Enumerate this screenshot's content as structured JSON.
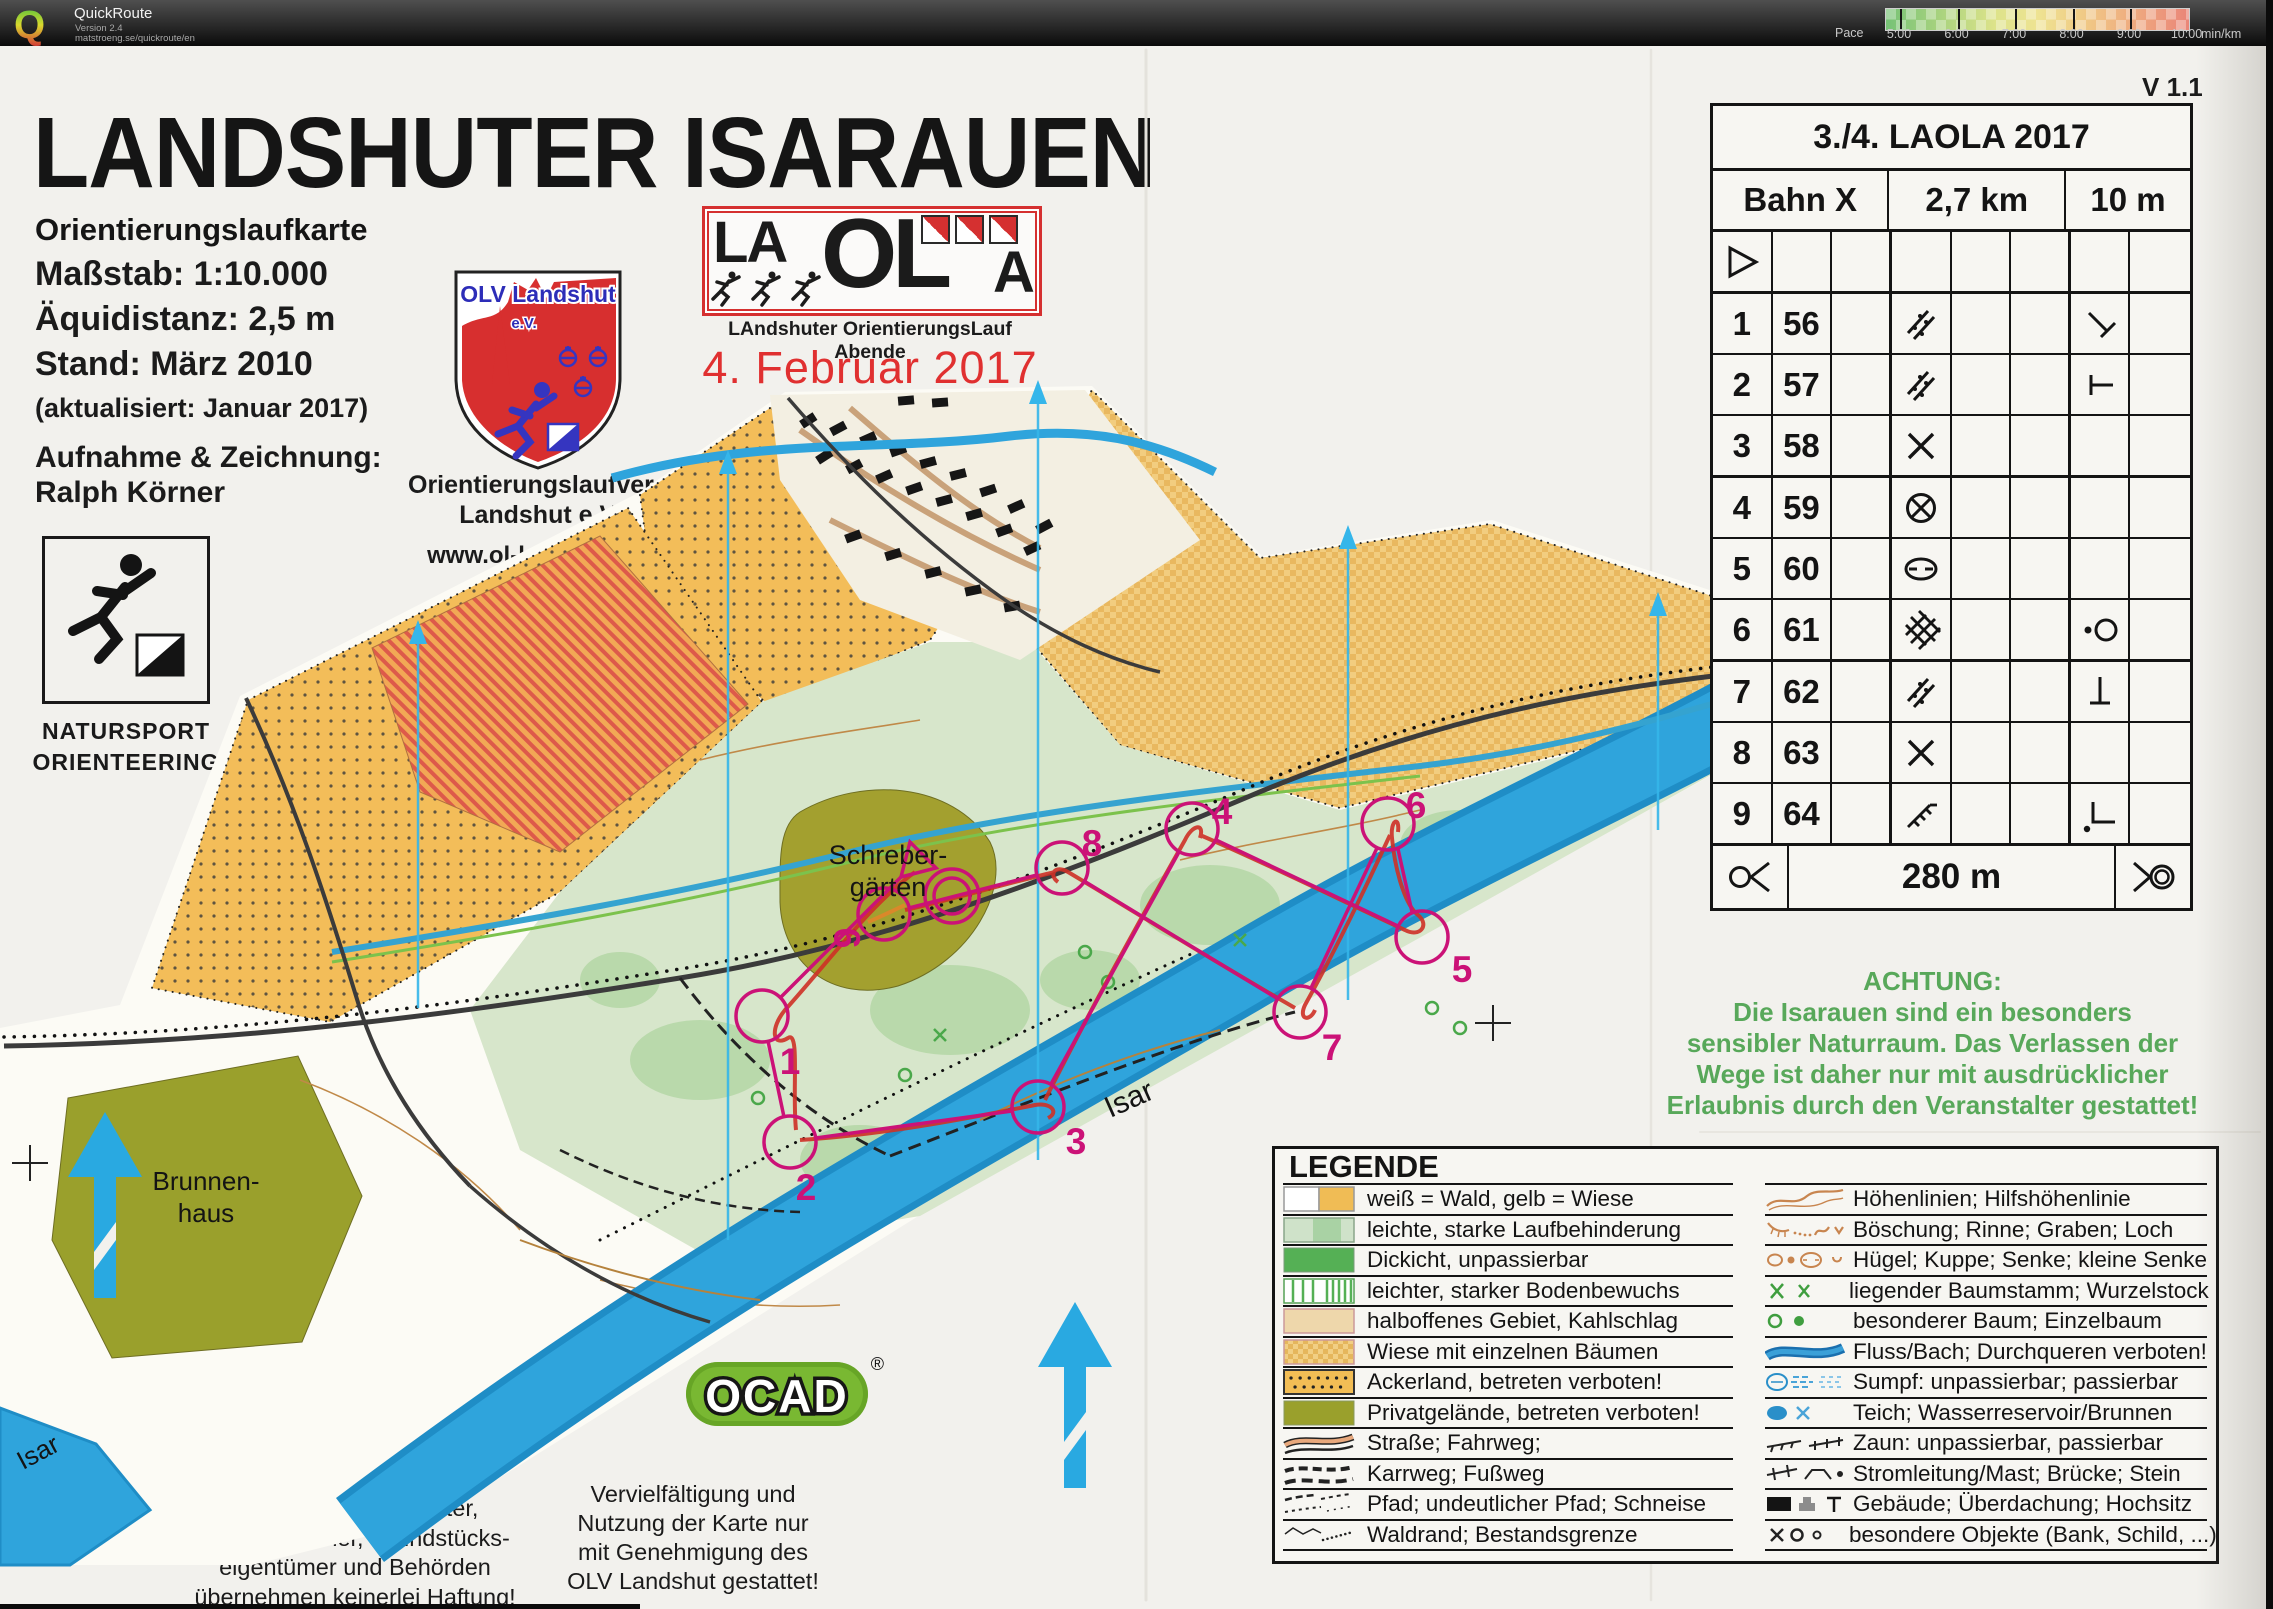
{
  "quickroute_bar": {
    "app_name": "QuickRoute",
    "version": "Version 2.4",
    "url": "matstroeng.se/quickroute/en",
    "pace_label": "Pace",
    "pace_ticks": [
      "5:00",
      "6:00",
      "7:00",
      "8:00",
      "9:00",
      "10:00"
    ],
    "pace_unit": "min/km"
  },
  "version_label": "V 1.1",
  "title_block": {
    "title": "LANDSHU​TER ISARAUEN",
    "subtitle": "Orientierungslaufkarte",
    "scale": "Maßstab: 1:10.000",
    "equidistance": "Äquidistanz: 2,5 m",
    "stand": "Stand: März 2010",
    "updated": "(aktualisiert: Januar 2017)",
    "survey_label": "Aufnahme & Zeichnung:",
    "survey_name": "Ralph Körner"
  },
  "natursport_logo": {
    "line1": "NATURSPORT",
    "line2": "ORIENTEERING"
  },
  "olv_logo": {
    "shield_title": "OLV Landshut",
    "shield_sub": "e.V.",
    "org_line1": "Orientierungslaufverein",
    "org_line2": "Landshut e.V.",
    "website": "www.ol-landshut.de"
  },
  "laola": {
    "letters": [
      "LA",
      "OL",
      "A"
    ],
    "tagline": "LAndshuter OrientierungsLauf Abende",
    "date": "4. Februar 2017"
  },
  "map_labels": {
    "allotments1": "Schreber-",
    "allotments2": "gärten",
    "well1": "Brunnen-",
    "well2": "haus",
    "river": "Isar",
    "river2": "Isar"
  },
  "course": {
    "controls": [
      "1",
      "2",
      "3",
      "4",
      "5",
      "6",
      "7",
      "8",
      "9"
    ]
  },
  "control_table": {
    "title": "3./4. LAOLA 2017",
    "course": "Bahn X",
    "length": "2,7 km",
    "climb": "10 m",
    "rows": [
      {
        "start": true,
        "num": "",
        "code": ""
      },
      {
        "num": "1",
        "code": "56",
        "d": "scattered-trees",
        "g": "junction-diagonal"
      },
      {
        "num": "2",
        "code": "57",
        "d": "scattered-trees",
        "g": "t-junction"
      },
      {
        "num": "3",
        "code": "58",
        "d": "crossing"
      },
      {
        "num": "4",
        "code": "59",
        "d": "circle-cross"
      },
      {
        "num": "5",
        "code": "60",
        "d": "depression"
      },
      {
        "num": "6",
        "code": "61",
        "d": "thicket",
        "g": "dot-circle"
      },
      {
        "num": "7",
        "code": "62",
        "d": "scattered-trees",
        "g": "perp-line"
      },
      {
        "num": "8",
        "code": "63",
        "d": "crossing"
      },
      {
        "num": "9",
        "code": "64",
        "d": "slope-ticks",
        "g": "corner-dot"
      }
    ],
    "finish_distance": "280 m"
  },
  "achtung": {
    "title": "ACHTUNG:",
    "lines": [
      "Die Isarauen sind ein besonders",
      "sensibler Naturraum. Das Verlassen der",
      "Wege ist daher nur mit ausdrücklicher",
      "Erlaubnis durch den Veranstalter gestattet!"
    ]
  },
  "legend": {
    "title": "LEGENDE",
    "left": [
      {
        "swatch": "wald-wiese",
        "label": "weiß = Wald, gelb = Wiese"
      },
      {
        "swatch": "laufbehinderung",
        "label": "leichte, starke Laufbehinderung"
      },
      {
        "swatch": "dickicht",
        "label": "Dickicht, unpassierbar"
      },
      {
        "swatch": "bodenbewuchs",
        "label": "leichter, starker Bodenbewuchs"
      },
      {
        "swatch": "halboffen",
        "label": "halboffenes Gebiet, Kahlschlag"
      },
      {
        "swatch": "wiese-baeume",
        "label": "Wiese mit einzelnen Bäumen"
      },
      {
        "swatch": "ackerland",
        "label": "Ackerland, betreten verboten!"
      },
      {
        "swatch": "privat",
        "label": "Privatgelände, betreten verboten!"
      },
      {
        "swatch": "strasse",
        "label": "Straße; Fahrweg;"
      },
      {
        "swatch": "karrweg",
        "label": "Karrweg; Fußweg"
      },
      {
        "swatch": "pfad",
        "label": "Pfad; undeutlicher Pfad; Schneise"
      },
      {
        "swatch": "waldrand",
        "label": "Waldrand; Bestandsgrenze"
      }
    ],
    "right": [
      {
        "swatch": "hoehenlinien",
        "label": "Höhenlinien; Hilfshöhenlinie"
      },
      {
        "swatch": "boeschung",
        "label": "Böschung; Rinne; Graben; Loch"
      },
      {
        "swatch": "huegel",
        "label": "Hügel; Kuppe; Senke; kleine Senke"
      },
      {
        "swatch": "baumstamm",
        "label": "liegender Baumstamm; Wurzelstock"
      },
      {
        "swatch": "baum",
        "label": "besonderer Baum; Einzelbaum"
      },
      {
        "swatch": "fluss",
        "label": "Fluss/Bach; Durchqueren verboten!"
      },
      {
        "swatch": "sumpf",
        "label": "Sumpf: unpassierbar; passierbar"
      },
      {
        "swatch": "teich",
        "label": "Teich; Wasserreservoir/Brunnen"
      },
      {
        "swatch": "zaun",
        "label": "Zaun: unpassierbar, passierbar"
      },
      {
        "swatch": "stromleitung",
        "label": "Stromleitung/Mast; Brücke; Stein"
      },
      {
        "swatch": "gebaeude",
        "label": "Gebäude; Überdachung; Hochsitz"
      },
      {
        "swatch": "objekte",
        "label": "besondere Objekte (Bank, Schild, ...)"
      }
    ]
  },
  "ocad": {
    "name": "OCAD",
    "reg": "®"
  },
  "footer": {
    "disclaimer": [
      "Veranstalter, Ausrichter,",
      "Kartenzeichner, Grundstücks-",
      "eigentümer und Behörden",
      "übernehmen keinerlei Haftung!"
    ],
    "usage": [
      "Vervielfältigung und",
      "Nutzung der Karte nur",
      "mit Genehmigung des",
      "OLV Landshut gestattet!"
    ]
  },
  "colors": {
    "course_magenta": "#cb1277",
    "river_blue": "#2fa4dc",
    "north_cyan": "#35b6ea",
    "achtung_green": "#58a85a",
    "meadow_yellow": "#f3bd59",
    "olive_private": "#9fa02e",
    "laola_red": "#d53030"
  }
}
